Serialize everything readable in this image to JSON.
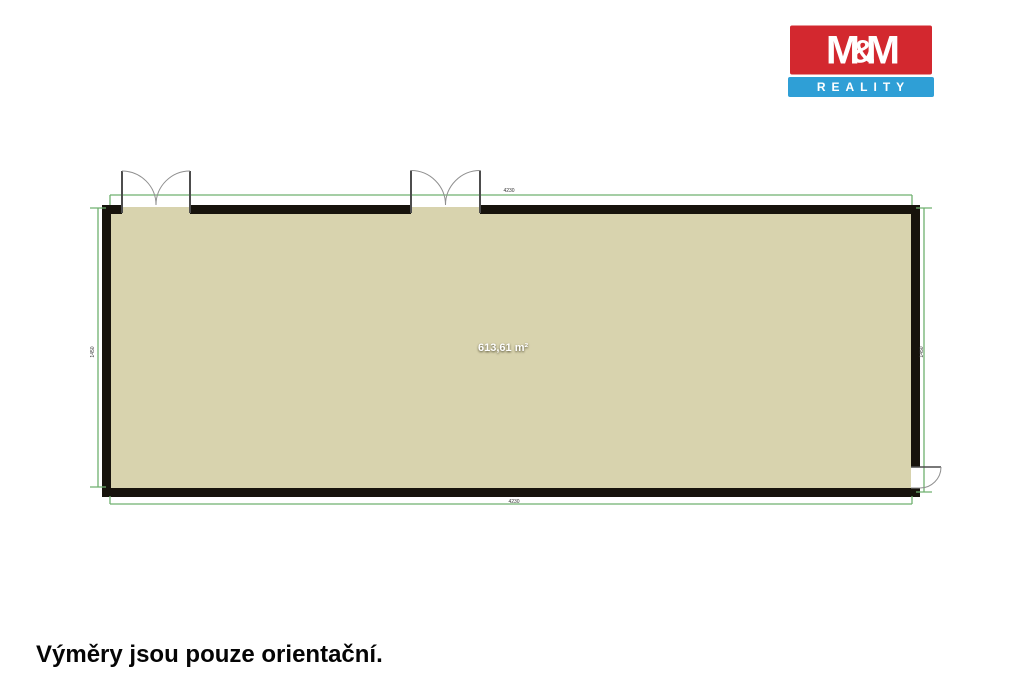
{
  "logo": {
    "title": "M&M",
    "subtitle": "REALITY",
    "red": "#d3282f",
    "blue": "#2f9fd6"
  },
  "plan": {
    "area_label": "613,61 m²",
    "floor_color": "#d8d3ae",
    "wall_color": "#17130c",
    "dimension_color": "#6fb06f",
    "dimensions": {
      "top": "4230",
      "bottom": "4230",
      "left": "1450",
      "right": "1450"
    }
  },
  "footer": {
    "note": "Výměry jsou pouze orientační."
  }
}
